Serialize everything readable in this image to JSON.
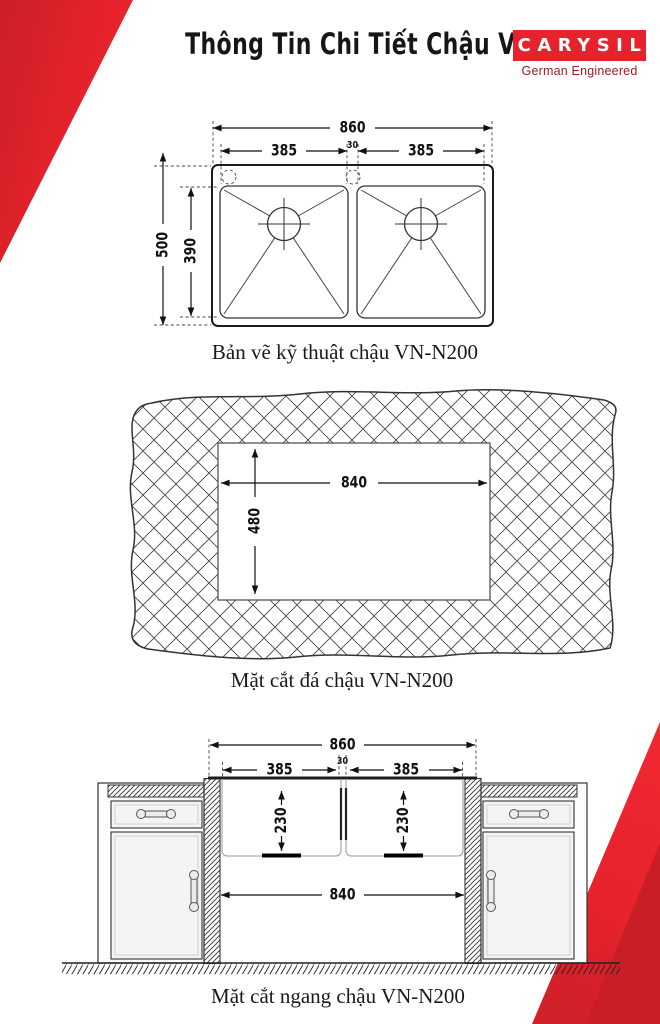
{
  "header": {
    "title": "Thông Tin Chi Tiết Chậu VN-N200",
    "brand": {
      "name": "CARYSIL",
      "tagline": "German Engineered"
    }
  },
  "colors": {
    "brand_red": "#e6222c",
    "brand_red_dark": "#c91e26",
    "tagline_red": "#9d1d20",
    "ink": "#111111"
  },
  "diagrams": {
    "technical": {
      "caption": "Bản vẽ kỹ thuật chậu VN-N200",
      "dims": {
        "overall_width": "860",
        "left_bowl_width": "385",
        "center_gap": "30",
        "right_bowl_width": "385",
        "overall_depth": "500",
        "bowl_depth": "390"
      }
    },
    "stone": {
      "caption": "Mặt cắt đá chậu VN-N200",
      "dims": {
        "cutout_width": "840",
        "cutout_depth": "480"
      }
    },
    "section": {
      "caption": "Mặt cắt ngang chậu VN-N200",
      "dims": {
        "overall_width": "860",
        "left_bowl_width": "385",
        "center_gap": "30",
        "right_bowl_width": "385",
        "left_bowl_depth": "230",
        "right_bowl_depth": "230",
        "inner_width": "840"
      }
    }
  }
}
